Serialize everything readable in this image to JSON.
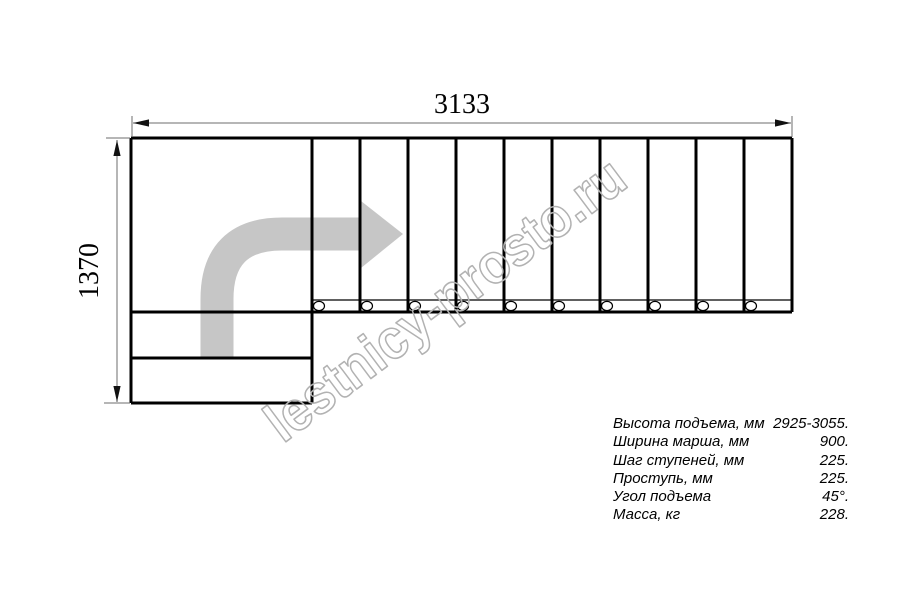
{
  "dimensions": {
    "width_mm": "3133",
    "height_mm": "1370"
  },
  "watermark": {
    "text": "lestnicy-prosto.ru"
  },
  "specs": {
    "rows": [
      {
        "label": "Высота подъема, мм",
        "value": "2925-3055."
      },
      {
        "label": "Ширина марша, мм",
        "value": "900."
      },
      {
        "label": "Шаг ступеней, мм",
        "value": "225."
      },
      {
        "label": "Проступь, мм",
        "value": "225."
      },
      {
        "label": "Угол подъема",
        "value": "45°."
      },
      {
        "label": "Масса, кг",
        "value": "228."
      }
    ]
  },
  "drawing": {
    "type": "L-shaped staircase plan view",
    "tread_count": 10,
    "icons": [
      "route-arrow-icon"
    ]
  },
  "colors": {
    "line": "#000000",
    "dim": "#6e6e6e",
    "dim-arrow": "#111111",
    "arrow": "#c6c6c6",
    "watermark": "#b2b2b2",
    "background": "#ffffff"
  }
}
